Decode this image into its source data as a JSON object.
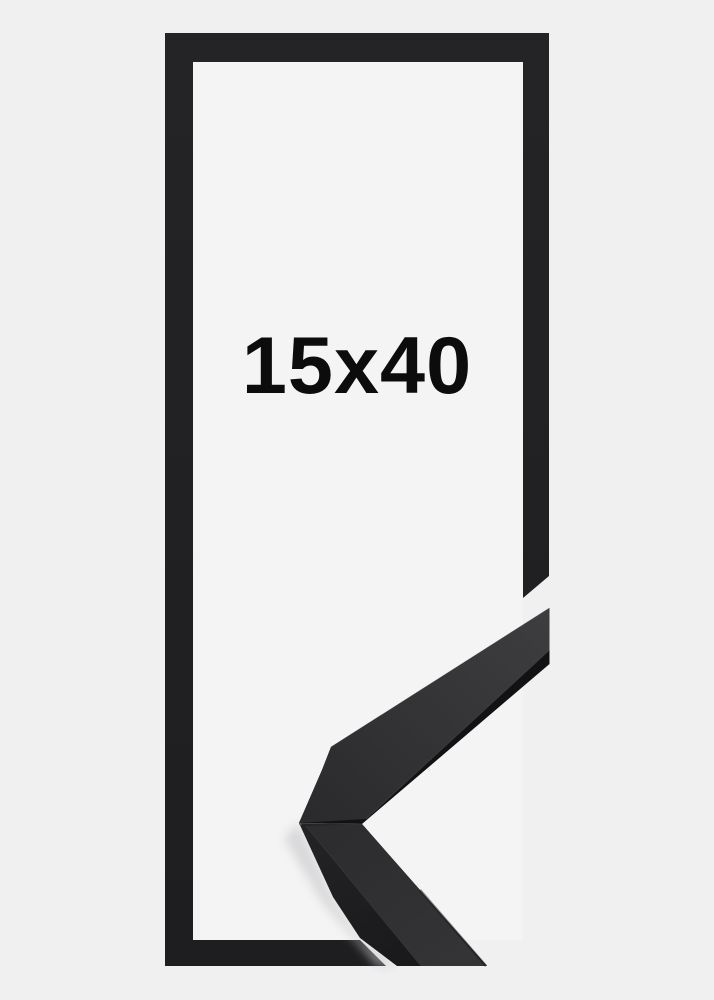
{
  "product_image": {
    "size_label": "15x40",
    "corner_detail_icon": "frame-moulding-corner-photo"
  },
  "colors": {
    "bg-outer": "#f0f0f1",
    "bg-inner": "#f4f4f4",
    "frame-black": "#222224",
    "label-text": "#0c0c0c",
    "moulding-dark-edge": "#121214",
    "moulding-side": "#1d1d20",
    "shadow": "#c9c9cc"
  }
}
